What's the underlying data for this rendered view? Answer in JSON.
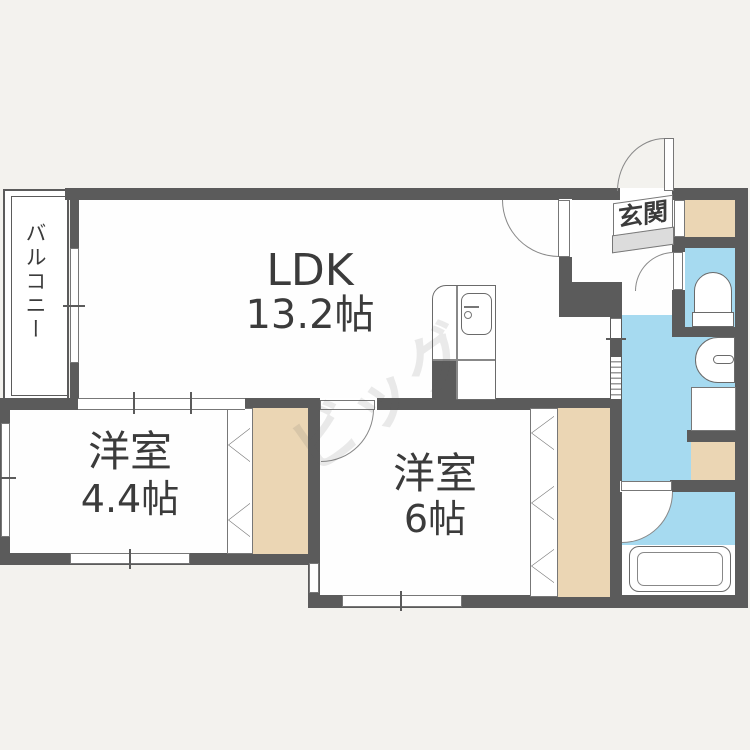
{
  "floor_plan": {
    "watermark": {
      "text": "ビッグ"
    },
    "rooms": {
      "ldk": {
        "label": "LDK",
        "size": "13.2帖"
      },
      "bedroom_a": {
        "label": "洋室",
        "size": "4.4帖"
      },
      "bedroom_b": {
        "label": "洋室",
        "size": "6帖"
      },
      "balcony": {
        "label": "バルコニー"
      },
      "entrance": {
        "label": "玄関"
      }
    },
    "fixtures": {
      "kitchen": "kitchen-sink-unit",
      "toilet": "toilet",
      "washbasin": "washbasin",
      "washer_space": "washing-machine-space",
      "bathtub": "bathtub"
    },
    "colors": {
      "wall": "#5b5b5b",
      "wet_area": "#a6daf0",
      "closet": "#ebd6b4",
      "background": "#f3f2ee",
      "room": "#fefefe",
      "step": "#dcdcdc"
    }
  }
}
